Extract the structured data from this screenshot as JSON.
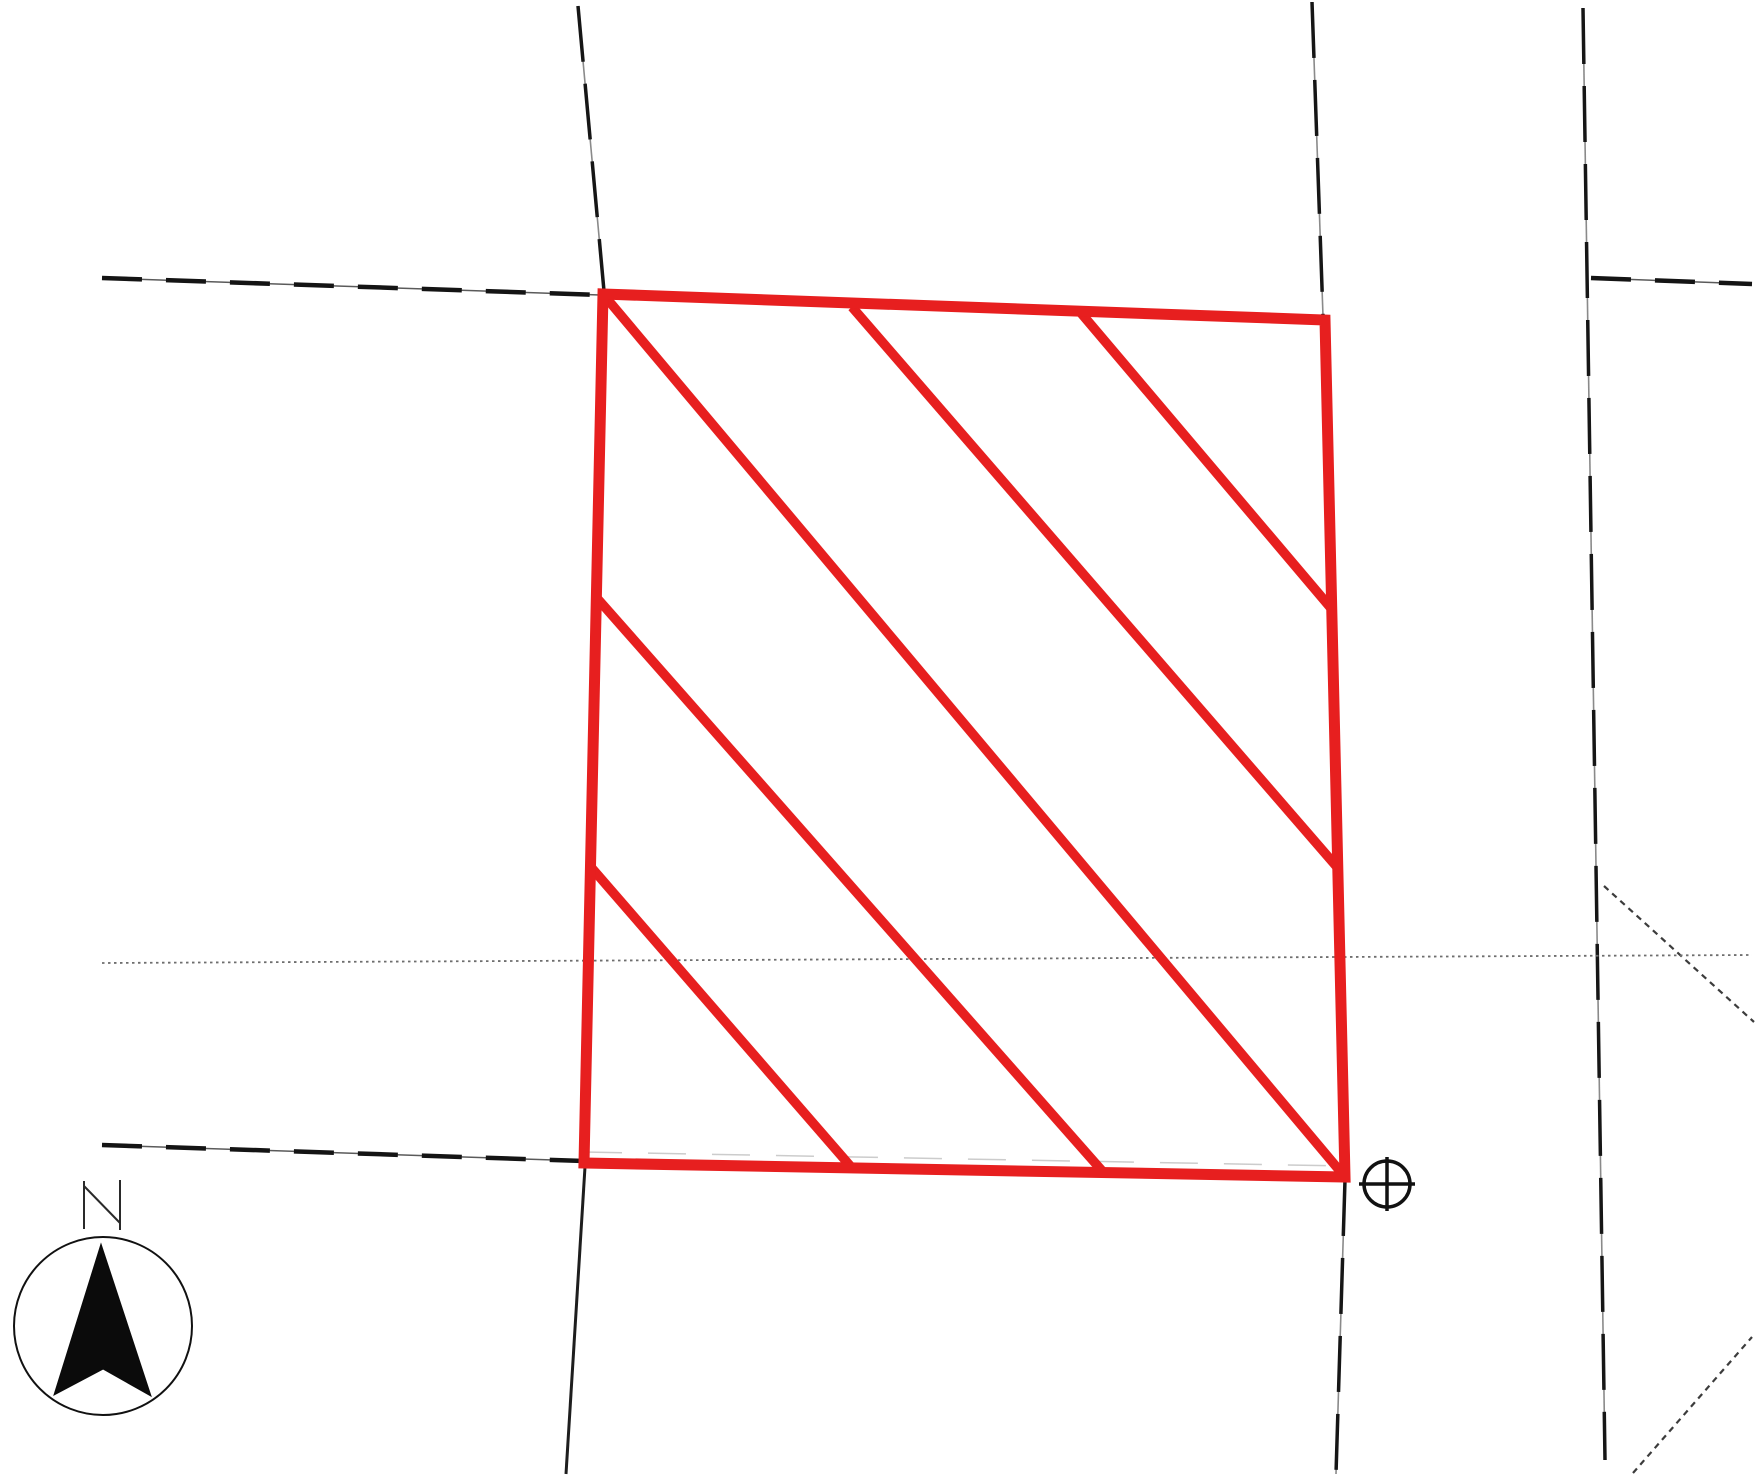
{
  "map": {
    "title": "plat-map-scan",
    "canvas": {
      "width": 1756,
      "height": 1475,
      "background": "#ffffff"
    },
    "parcel": {
      "name": "subject-parcel",
      "outline_color": "#e71f1f",
      "outline_width": 11,
      "hatch_width": 9.5,
      "corners": [
        [
          603,
          294
        ],
        [
          1325,
          320
        ],
        [
          1345,
          1177
        ],
        [
          584,
          1163
        ]
      ],
      "hatch_lines": [
        [
          [
            1081,
            313
          ],
          [
            1330,
            607
          ]
        ],
        [
          [
            852,
            307
          ],
          [
            1337,
            867
          ]
        ],
        [
          [
            603,
            294
          ],
          [
            1345,
            1177
          ]
        ],
        [
          [
            596,
            597
          ],
          [
            1104,
            1173
          ]
        ],
        [
          [
            590,
            866
          ],
          [
            852,
            1168
          ]
        ]
      ]
    },
    "line_styles": {
      "dash-bold": [
        {
          "color": "#5a5a5a",
          "width": 1.5
        },
        {
          "color": "#141414",
          "width": 4.5,
          "dash": "40 24"
        }
      ],
      "road-solid": [
        {
          "color": "#1e1e1e",
          "width": 3
        }
      ],
      "road-dash-long": [
        {
          "color": "#8a8a8a",
          "width": 1.6
        },
        {
          "color": "#161616",
          "width": 3.5,
          "dash": "56 22"
        }
      ],
      "speckle": [
        {
          "color": "#3c3c3c",
          "width": 2.2,
          "dash": "6 5"
        }
      ],
      "dotted-fine": [
        {
          "color": "#6e6e6e",
          "width": 1.8,
          "dash": "2.5 3.5"
        }
      ],
      "ghost": [
        {
          "color": "#9a9a9a",
          "width": 1.5,
          "dash": "38 26",
          "opacity": 0.5
        }
      ]
    },
    "boundary_lines": [
      {
        "name": "road-line-topleft-vertical",
        "style": "road-dash-long",
        "points": [
          [
            578,
            6
          ],
          [
            604,
            291
          ]
        ]
      },
      {
        "name": "lot-line-topleft-dashed",
        "style": "dash-bold",
        "points": [
          [
            102,
            278
          ],
          [
            600,
            295
          ]
        ]
      },
      {
        "name": "road-line-topcenter-vertical",
        "style": "road-dash-long",
        "points": [
          [
            1312,
            2
          ],
          [
            1323,
            316
          ]
        ]
      },
      {
        "name": "road-line-right-vertical",
        "style": "road-dash-long",
        "points": [
          [
            1583,
            8
          ],
          [
            1605,
            1460
          ]
        ]
      },
      {
        "name": "lot-line-topright-dashed",
        "style": "dash-bold",
        "points": [
          [
            1591,
            278
          ],
          [
            1752,
            284
          ]
        ]
      },
      {
        "name": "branch-diagonal-right",
        "style": "speckle",
        "points": [
          [
            1604,
            886
          ],
          [
            1754,
            1022
          ]
        ]
      },
      {
        "name": "diagonal-bottom-right",
        "style": "speckle",
        "points": [
          [
            1633,
            1473
          ],
          [
            1752,
            1337
          ]
        ]
      },
      {
        "name": "section-dotted-line",
        "style": "dotted-fine",
        "points": [
          [
            102,
            963
          ],
          [
            1752,
            955
          ]
        ]
      },
      {
        "name": "lot-line-bottomleft-dashed",
        "style": "dash-bold",
        "points": [
          [
            102,
            1145
          ],
          [
            584,
            1161
          ]
        ]
      },
      {
        "name": "road-line-below-parcel-left",
        "style": "road-solid",
        "points": [
          [
            585,
            1167
          ],
          [
            566,
            1474
          ]
        ]
      },
      {
        "name": "road-line-below-parcel-right",
        "style": "road-dash-long",
        "points": [
          [
            1345,
            1180
          ],
          [
            1336,
            1474
          ]
        ]
      },
      {
        "name": "ghost-lot-line-top",
        "style": "ghost",
        "points": [
          [
            603,
            290
          ],
          [
            1325,
            316
          ]
        ]
      },
      {
        "name": "ghost-lot-line-bottom",
        "style": "ghost",
        "points": [
          [
            584,
            1152
          ],
          [
            1345,
            1166
          ]
        ]
      }
    ],
    "survey_marker": {
      "name": "circle-plus-marker",
      "color": "#111111",
      "width": 3.5,
      "circle": {
        "cx": 1387,
        "cy": 1184,
        "r": 23
      },
      "cross_h": [
        [
          1359,
          1184
        ],
        [
          1415,
          1184
        ]
      ],
      "cross_v": [
        [
          1387,
          1157
        ],
        [
          1387,
          1211
        ]
      ]
    },
    "north_indicator": {
      "label": "N",
      "circle": {
        "cx": 103,
        "cy": 1326,
        "r": 89,
        "stroke": "#111111",
        "width": 2
      },
      "arrow_color": "#0b0b0b",
      "arrow_points": [
        [
          101,
          1244
        ],
        [
          151,
          1396
        ],
        [
          103,
          1369
        ],
        [
          54,
          1395
        ]
      ],
      "letter_color": "#2a2a2a",
      "letter_width": 2,
      "letter_strokes": [
        [
          [
            84,
            1181
          ],
          [
            84,
            1229
          ]
        ],
        [
          [
            84,
            1186
          ],
          [
            120,
            1223
          ]
        ],
        [
          [
            120,
            1180
          ],
          [
            120,
            1230
          ]
        ]
      ]
    }
  }
}
